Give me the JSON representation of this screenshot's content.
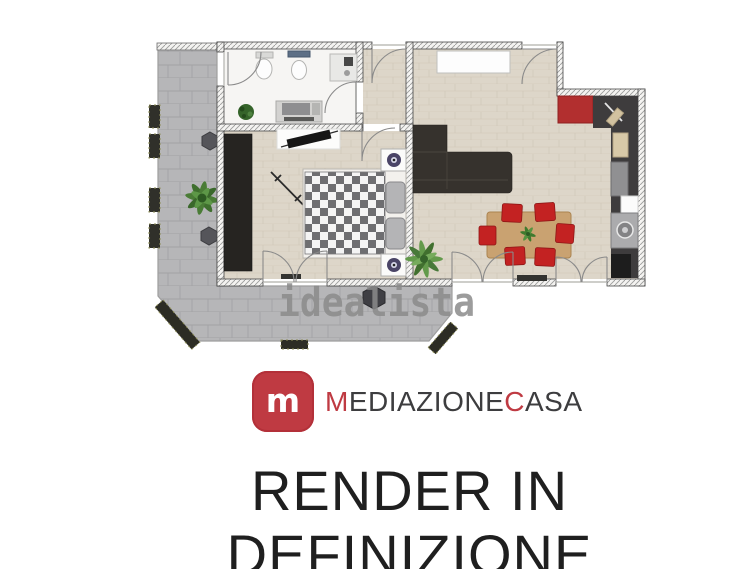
{
  "watermark": {
    "text": "idealista",
    "color": "#8b8b8b"
  },
  "logo": {
    "icon_letter": "m",
    "icon_bg": "#bf3a42",
    "part1": "M",
    "part2": "EDIAZIONE",
    "part3": "C",
    "part4": "ASA",
    "full_name": "MediazioneCasa",
    "text_color": "#3d3d3f",
    "accent_color": "#bf3a42"
  },
  "caption": {
    "text": "RENDER IN DEFINIZIONE",
    "color": "#1f1f1f"
  },
  "floorplan": {
    "type": "apartment-render-top-view",
    "colors": {
      "terrace_paving": "#b6b6b8",
      "wood_floor": "#ddd6c9",
      "bathroom_floor": "#f6f5f3",
      "kitchen_counter": "#3e3c3d",
      "sofa": "#36322d",
      "wardrobe": "#262421",
      "dining_table": "#c9a271",
      "chair_red": "#c32222",
      "cabinet_red": "#b22f2f",
      "plant_green": "#4a7c36"
    }
  }
}
